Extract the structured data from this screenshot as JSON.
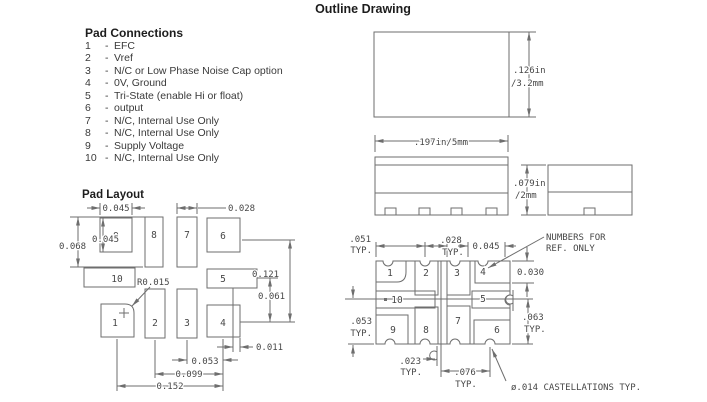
{
  "title": "Outline Drawing",
  "pad_connections": {
    "heading": "Pad Connections",
    "sep": "-",
    "items": [
      {
        "num": "1",
        "desc": "EFC"
      },
      {
        "num": "2",
        "desc": "Vref"
      },
      {
        "num": "3",
        "desc": "N/C or Low Phase Noise Cap option"
      },
      {
        "num": "4",
        "desc": "0V, Ground"
      },
      {
        "num": "5",
        "desc": "Tri-State (enable Hi or float)"
      },
      {
        "num": "6",
        "desc": "output"
      },
      {
        "num": "7",
        "desc": "N/C, Internal Use Only"
      },
      {
        "num": "8",
        "desc": "N/C, Internal Use Only"
      },
      {
        "num": "9",
        "desc": "Supply Voltage"
      },
      {
        "num": "10",
        "desc": "N/C, Internal Use Only"
      }
    ]
  },
  "pad_layout": {
    "heading": "Pad Layout",
    "labels": [
      "1",
      "2",
      "3",
      "4",
      "5",
      "6",
      "7",
      "8",
      "9",
      "10"
    ],
    "dims": {
      "pad9_width": "0.045",
      "pad7_width": "0.028",
      "col_height": "0.068",
      "pad9_height": "0.045",
      "corner_radius": "R0.015",
      "row_6_to_4": "0.121",
      "row_5_to_4": "0.061",
      "pad_offset": "0.011",
      "pitch_3_4": "0.053",
      "pitch_2_4": "0.099",
      "pitch_1_4": "0.152"
    }
  },
  "views": {
    "top_height_in": ".126in",
    "top_height_mm": "/3.2mm",
    "side_width": ".197in/5mm",
    "end_height_in": ".079in",
    "end_height_mm": "/2mm"
  },
  "bottom_view": {
    "labels": [
      "1",
      "2",
      "3",
      "4",
      "5",
      "6",
      "7",
      "8",
      "9",
      "10"
    ],
    "typ": "TYP.",
    "note_line1": "NUMBERS FOR",
    "note_line2": "REF. ONLY",
    "castellation_note": "ø.014 CASTELLATIONS TYP.",
    "dims": {
      "left_pitch": ".051",
      "center_pitch": ".028",
      "pad4_width": "0.045",
      "pad4_height": "0.030",
      "right_span": ".063",
      "left_span": ".053",
      "center_offset": ".023",
      "bottom_pitch": ".076"
    }
  }
}
